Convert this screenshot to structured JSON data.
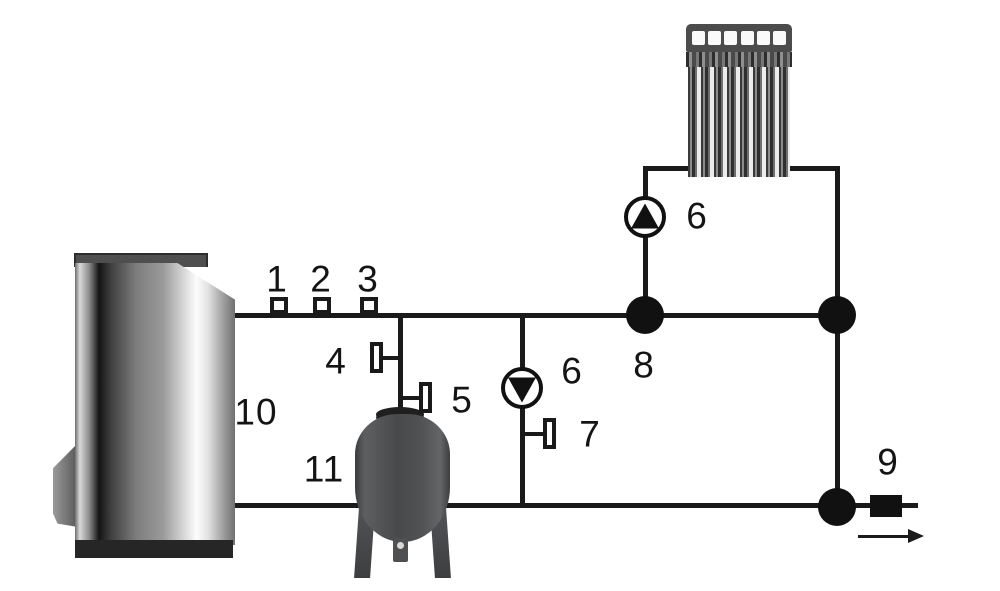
{
  "meta": {
    "title": "heating-system-schematic"
  },
  "colors": {
    "background": "#ffffff",
    "line": "#1a1a1a",
    "junction": "#111111",
    "tank_body": "#47494b",
    "boiler_highlight": "#fdfdfd",
    "boiler_shadow": "#141414",
    "radiator_dark": "#3a3a3a",
    "radiator_light": "#ececec"
  },
  "icons": {
    "pump_circulation": "pump-icon-triangle-down",
    "pump_boiler_loop": "pump-icon-triangle-up",
    "fittings": "square-fitting-icon",
    "valves": "stub-valve-icon",
    "junctions": "junction-dot",
    "outlet": "outlet-fitting",
    "flow": "flow-direction-arrow"
  },
  "labels": {
    "l1": "1",
    "l2": "2",
    "l3": "3",
    "l4": "4",
    "l5": "5",
    "l6_circulation_pump": "6",
    "l6_boiler_pump": "6",
    "l7": "7",
    "l8": "8",
    "l9": "9",
    "l10": "10",
    "l11": "11"
  }
}
